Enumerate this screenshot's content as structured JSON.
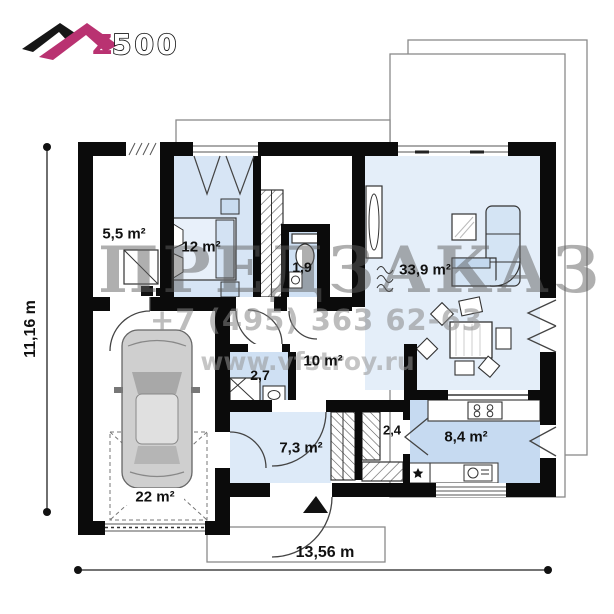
{
  "logo": {
    "z_label": "Z",
    "rest_label": "500"
  },
  "watermark": {
    "big_text": "ПРЕДЗАКАЗ",
    "phone": "+7 (495) 363 62-63",
    "site": "www.vfstroy.ru"
  },
  "dimensions": {
    "height_label": "11,16 m",
    "width_label": "13,56 m"
  },
  "rooms": [
    {
      "name": "technical-room",
      "area": "5,5 m²"
    },
    {
      "name": "bedroom",
      "area": "12 m²"
    },
    {
      "name": "wc",
      "area": "1,9"
    },
    {
      "name": "living-room",
      "area": "33,9 m²"
    },
    {
      "name": "corridor",
      "area": "10 m²"
    },
    {
      "name": "bathroom",
      "area": "2,7"
    },
    {
      "name": "hall",
      "area": "7,3 m²"
    },
    {
      "name": "closet",
      "area": "2,4"
    },
    {
      "name": "kitchen",
      "area": "8,4 m²"
    },
    {
      "name": "garage",
      "area": "22 m²"
    }
  ],
  "colors": {
    "accent_magenta": "#b93271",
    "wall": "#0b0b0b",
    "room_blue": "#d7e5f5",
    "room_blue_light": "#e4eef9",
    "room_blue_deep": "#c6daf1"
  }
}
